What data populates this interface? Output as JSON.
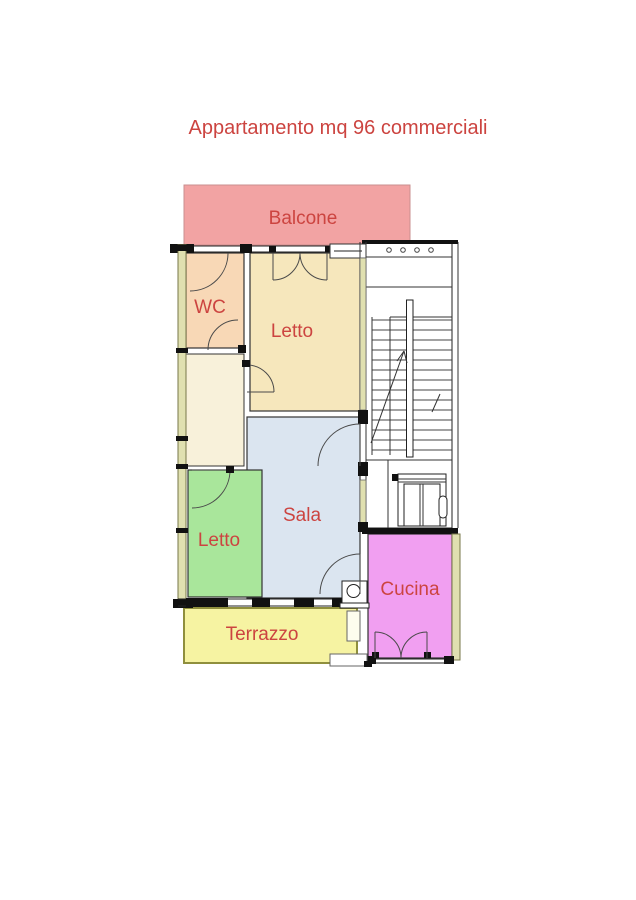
{
  "title": {
    "text": "Appartamento mq 96 commerciali"
  },
  "rooms": {
    "balcone": {
      "label": "Balcone"
    },
    "wc": {
      "label": "WC"
    },
    "letto_top": {
      "label": "Letto"
    },
    "sala": {
      "label": "Sala"
    },
    "letto_bottom": {
      "label": "Letto"
    },
    "cucina": {
      "label": "Cucina"
    },
    "terrazzo": {
      "label": "Terrazzo"
    }
  },
  "colors": {
    "label_red": "#cc4440",
    "balcone_fill": "#f2a3a3",
    "balcone_border": "#c98f8f",
    "wc_fill": "#f8d8b6",
    "letto_top_fill": "#f6e7bc",
    "corridor_fill": "#f8f1da",
    "sala_fill": "#dbe5f0",
    "letto_bottom_fill": "#a9e69b",
    "cucina_fill": "#f19ff1",
    "terrazzo_fill": "#f6f3a2",
    "terrazzo_border": "#8f8f3d",
    "wall_strip_fill": "#e0e0b0",
    "stair_fill": "#ffffff",
    "line_dark": "#1d1d1d"
  }
}
